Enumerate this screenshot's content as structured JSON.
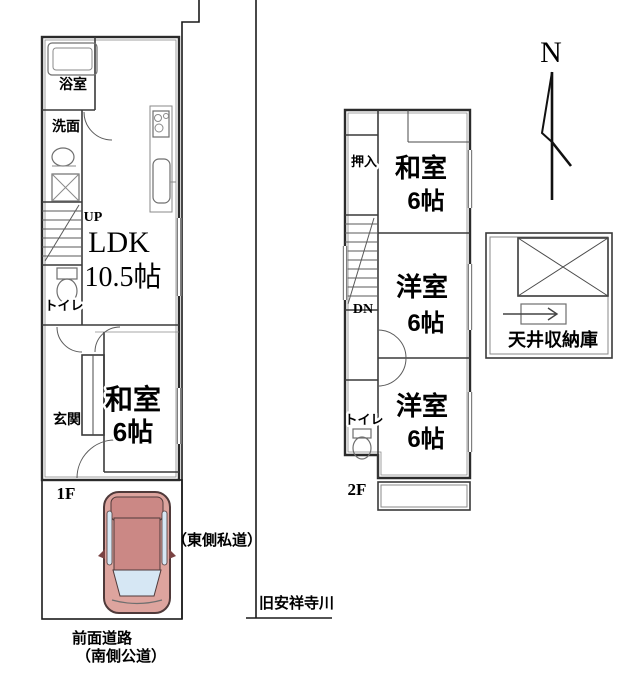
{
  "compass": {
    "label": "N"
  },
  "floor1": {
    "label": "1F",
    "bath": "浴室",
    "washroom": "洗面",
    "stairs_up": "UP",
    "ldk_name": "LDK",
    "ldk_size": "10.5帖",
    "toilet": "トイレ",
    "entrance": "玄関",
    "japanese_room_name": "和室",
    "japanese_room_size": "6帖"
  },
  "floor2": {
    "label": "2F",
    "closet": "押入",
    "japanese_room_name": "和室",
    "japanese_room_size": "6帖",
    "stairs_down": "DN",
    "western_room1_name": "洋室",
    "western_room1_size": "6帖",
    "western_room2_name": "洋室",
    "western_room2_size": "6帖",
    "toilet": "トイレ"
  },
  "attic": {
    "label": "天井収納庫"
  },
  "surroundings": {
    "east_road": "（東側私道）",
    "river": "旧安祥寺川",
    "front_road_line1": "前面道路",
    "front_road_line2": "（南側公道）"
  },
  "colors": {
    "car_body": "#dda49e",
    "car_roof": "#cb8885",
    "car_glass": "#d6e7f4"
  }
}
